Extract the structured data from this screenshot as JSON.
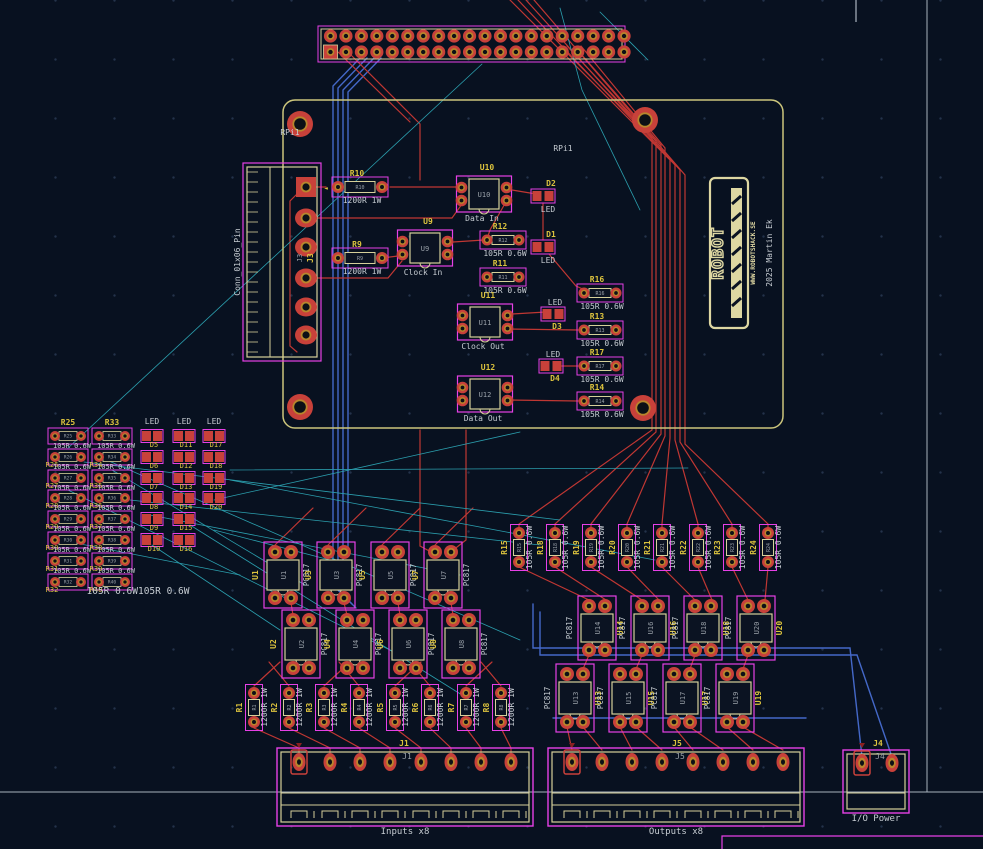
{
  "app": {
    "view_name": "pcb-layout-editor-canvas"
  },
  "colors": {
    "bg": "#081120",
    "grid_dot": "#24324a",
    "copper_red": "#c03733",
    "pad_red": "#c8413a",
    "gold": "#b8862c",
    "hole": "#0c1016",
    "courtyard_magenta": "#e640e6",
    "silk_cream": "#d6d09a",
    "ref_yellow": "#dcc33e",
    "text_white": "#c6ccd2",
    "copper_blue": "#4468c8",
    "ratsnest_cyan": "#2b9fae",
    "board_edge": "#ccc67c",
    "frame_gray": "#a8b2bd",
    "inner_ref_gray": "#9aa1a9",
    "logo_cream": "#ded7a2",
    "pin1_dark_red": "#8a2020"
  },
  "labels": {
    "rpi_hole": "RPi1",
    "rpi_silk": "RPi1",
    "led": "LED",
    "pc817": "PC817",
    "conn_left": "Conn_01x06_Pin",
    "inputs": "Inputs x8",
    "outputs": "Outputs x8",
    "io_power": "I/O Power"
  },
  "logo": {
    "text": "ROBOT",
    "url": "WWW.ROBOTSHACK.SE",
    "credit": "2025 Martin Ek"
  },
  "header40": {
    "x": 318,
    "y": 26,
    "w": 307,
    "h": 36,
    "rows_y": [
      36,
      52
    ],
    "x0": 330.5,
    "pitch": 15.45,
    "cols": 20
  },
  "j3": {
    "ref": "J3",
    "name": "Conn_01x06_Pin",
    "box": [
      243,
      163,
      78,
      198
    ],
    "pads_x": 306,
    "pads_y": [
      187,
      218,
      247,
      278,
      307,
      335
    ]
  },
  "hat": {
    "edge": [
      283,
      100,
      500,
      328
    ],
    "holes": [
      [
        300,
        124
      ],
      [
        645,
        120
      ],
      [
        300,
        407
      ],
      [
        643,
        408
      ]
    ]
  },
  "hat_resistors": [
    {
      "ref": "R10",
      "value": "1200R 1W",
      "cx": 360,
      "cy": 187,
      "size": "big"
    },
    {
      "ref": "R9",
      "value": "1200R 1W",
      "cx": 360,
      "cy": 258,
      "size": "big"
    },
    {
      "ref": "R12",
      "value": "105R 0.6W",
      "cx": 503,
      "cy": 240,
      "size": "small"
    },
    {
      "ref": "R11",
      "value": "105R 0.6W",
      "cx": 503,
      "cy": 277,
      "size": "small"
    },
    {
      "ref": "R16",
      "value": "105R 0.6W",
      "cx": 600,
      "cy": 293,
      "size": "small"
    },
    {
      "ref": "R13",
      "value": "105R 0.6W",
      "cx": 600,
      "cy": 330,
      "size": "small"
    },
    {
      "ref": "R17",
      "value": "105R 0.6W",
      "cx": 600,
      "cy": 366,
      "size": "small"
    },
    {
      "ref": "R14",
      "value": "105R 0.6W",
      "cx": 600,
      "cy": 401,
      "size": "small"
    }
  ],
  "hat_optos": [
    {
      "ref": "U10",
      "label": "Data In",
      "cx": 484,
      "cy": 194
    },
    {
      "ref": "U9",
      "label": "Clock In",
      "cx": 425,
      "cy": 248
    },
    {
      "ref": "U11",
      "label": "Clock Out",
      "cx": 485,
      "cy": 322
    },
    {
      "ref": "U12",
      "label": "Data Out",
      "cx": 485,
      "cy": 394
    }
  ],
  "hat_leds": [
    {
      "ref": "D2",
      "cx": 543,
      "cy": 196,
      "ref_pos": "above"
    },
    {
      "ref": "D1",
      "cx": 543,
      "cy": 247,
      "ref_pos": "above"
    },
    {
      "ref": "D3",
      "cx": 553,
      "cy": 314,
      "ref_pos": "below"
    },
    {
      "ref": "D4",
      "cx": 551,
      "cy": 366,
      "ref_pos": "below"
    }
  ],
  "left_array": {
    "value": "105R 0.6W",
    "bottom_value": "105R 0.6W105R 0.6W",
    "res_rows_y": [
      436,
      457,
      478,
      498,
      519,
      540,
      561,
      582
    ],
    "res_cols": [
      {
        "x": 68,
        "refs": [
          "R25",
          "R26",
          "R27",
          "R28",
          "R29",
          "R30",
          "R31",
          "R32"
        ]
      },
      {
        "x": 112,
        "refs": [
          "R33",
          "R34",
          "R35",
          "R36",
          "R37",
          "R38",
          "R39",
          "R40"
        ]
      }
    ],
    "led_rows_y": [
      436,
      457,
      478,
      498,
      519,
      540
    ],
    "led_cols": [
      {
        "x": 152,
        "refs": [
          "D5",
          "D6",
          "D7",
          "D8",
          "D9",
          "D10"
        ]
      },
      {
        "x": 184,
        "refs": [
          "D11",
          "D12",
          "D13",
          "D14",
          "D15",
          "D16"
        ]
      },
      {
        "x": 214,
        "refs": [
          "D17",
          "D18",
          "D19",
          "D20"
        ]
      }
    ]
  },
  "input_section": {
    "opto_value": "PC817",
    "opto_top": {
      "refs": [
        "U1",
        "U3",
        "U5",
        "U7"
      ],
      "cx": [
        283,
        336,
        390,
        443
      ],
      "pads_y": [
        552,
        598
      ]
    },
    "opto_bottom": {
      "refs": [
        "U2",
        "U4",
        "U6",
        "U8"
      ],
      "cx": [
        301,
        355,
        408,
        461
      ],
      "pads_y": [
        620,
        668
      ]
    },
    "res_refs": [
      "R1",
      "R2",
      "R3",
      "R4",
      "R5",
      "R6",
      "R7",
      "R8"
    ],
    "res_value": "1200R 1W",
    "res_x": [
      254,
      289,
      324,
      359,
      395,
      430,
      466,
      501
    ],
    "res_pads_y": [
      693,
      722
    ]
  },
  "output_section": {
    "opto_value": "PC817",
    "opto_top": {
      "refs": [
        "U14",
        "U16",
        "U18",
        "U20"
      ],
      "cx": [
        597,
        650,
        703,
        756
      ],
      "pads_y": [
        606,
        650
      ]
    },
    "opto_bottom": {
      "refs": [
        "U13",
        "U15",
        "U17",
        "U19"
      ],
      "cx": [
        575,
        628,
        682,
        735
      ],
      "pads_y": [
        674,
        722
      ]
    },
    "res_refs": [
      "R15",
      "R18",
      "R19",
      "R20",
      "R21",
      "R22",
      "R23",
      "R24"
    ],
    "res_value": "105R 0.6W",
    "res_x": [
      519,
      555,
      591,
      627,
      662,
      698,
      732,
      768
    ],
    "res_pads_y": [
      533,
      562
    ]
  },
  "connectors": {
    "j1": {
      "ref": "J1",
      "label": "Inputs x8",
      "box": [
        277,
        748,
        256,
        78
      ],
      "pads_x": [
        299,
        330,
        360,
        390,
        421,
        451,
        481,
        511
      ],
      "pads_y": 762
    },
    "j5": {
      "ref": "J5",
      "label": "Outputs x8",
      "box": [
        548,
        748,
        256,
        78
      ],
      "pads_x": [
        572,
        602,
        632,
        662,
        693,
        723,
        753,
        783
      ],
      "pads_y": 762
    },
    "j4": {
      "ref": "J4",
      "label": "I/O Power",
      "box": [
        843,
        750,
        66,
        63
      ],
      "pads_x": [
        862,
        892
      ],
      "pads_y": 763
    }
  },
  "traces": {
    "red": [
      [
        [
          560,
          46
        ],
        [
          652,
          138
        ],
        [
          652,
          430
        ],
        [
          519,
          524
        ],
        [
          519,
          531
        ]
      ],
      [
        [
          567,
          46
        ],
        [
          656,
          141
        ],
        [
          656,
          432
        ],
        [
          555,
          524
        ],
        [
          555,
          531
        ]
      ],
      [
        [
          574,
          46
        ],
        [
          661,
          145
        ],
        [
          661,
          434
        ],
        [
          591,
          524
        ],
        [
          591,
          531
        ]
      ],
      [
        [
          581,
          46
        ],
        [
          665,
          148
        ],
        [
          665,
          436
        ],
        [
          627,
          524
        ],
        [
          627,
          531
        ]
      ],
      [
        [
          510,
          0
        ],
        [
          670,
          160
        ],
        [
          670,
          438
        ],
        [
          662,
          524
        ],
        [
          662,
          531
        ]
      ],
      [
        [
          518,
          0
        ],
        [
          675,
          165
        ],
        [
          675,
          440
        ],
        [
          698,
          524
        ],
        [
          698,
          531
        ]
      ],
      [
        [
          526,
          0
        ],
        [
          680,
          170
        ],
        [
          680,
          442
        ],
        [
          732,
          524
        ],
        [
          732,
          531
        ]
      ],
      [
        [
          534,
          0
        ],
        [
          685,
          175
        ],
        [
          685,
          444
        ],
        [
          768,
          524
        ],
        [
          768,
          531
        ]
      ],
      [
        [
          390,
          187
        ],
        [
          457,
          187
        ]
      ],
      [
        [
          315,
          218
        ],
        [
          452,
          218
        ],
        [
          462,
          204
        ]
      ],
      [
        [
          453,
          242
        ],
        [
          484,
          240
        ]
      ],
      [
        [
          382,
          258
        ],
        [
          398,
          256
        ]
      ],
      [
        [
          512,
          190
        ],
        [
          536,
          194
        ]
      ],
      [
        [
          543,
          203
        ],
        [
          543,
          240
        ]
      ],
      [
        [
          549,
          254
        ],
        [
          576,
          286
        ],
        [
          585,
          290
        ]
      ],
      [
        [
          507,
          200
        ],
        [
          490,
          230
        ],
        [
          488,
          236
        ]
      ],
      [
        [
          506,
          329
        ],
        [
          578,
          330
        ]
      ],
      [
        [
          512,
          314
        ],
        [
          546,
          312
        ]
      ],
      [
        [
          560,
          366
        ],
        [
          578,
          366
        ]
      ],
      [
        [
          506,
          400
        ],
        [
          578,
          401
        ]
      ],
      [
        [
          306,
          278
        ],
        [
          388,
          278
        ],
        [
          402,
          261
        ]
      ],
      [
        [
          306,
          187
        ],
        [
          326,
          187
        ]
      ],
      [
        [
          297,
          194
        ],
        [
          290,
          201
        ],
        [
          290,
          346
        ],
        [
          297,
          352
        ]
      ],
      [
        [
          420,
          430
        ],
        [
          420,
          546
        ],
        [
          433,
          553
        ]
      ],
      [
        [
          466,
          430
        ],
        [
          466,
          540
        ],
        [
          452,
          551
        ]
      ],
      [
        [
          348,
          52
        ],
        [
          420,
          124
        ],
        [
          420,
          180
        ]
      ],
      [
        [
          338,
          52
        ],
        [
          410,
          122
        ]
      ]
    ],
    "blue": [
      [
        [
          360,
          58
        ],
        [
          333,
          86
        ],
        [
          333,
          585
        ],
        [
          352,
          604
        ]
      ],
      [
        [
          367,
          58
        ],
        [
          338,
          88
        ],
        [
          338,
          590
        ],
        [
          356,
          608
        ]
      ],
      [
        [
          374,
          58
        ],
        [
          343,
          90
        ],
        [
          343,
          560
        ]
      ],
      [
        [
          381,
          58
        ],
        [
          348,
          92
        ],
        [
          348,
          555
        ]
      ],
      [
        [
          533,
          604
        ],
        [
          533,
          648
        ],
        [
          850,
          648
        ],
        [
          862,
          757
        ]
      ],
      [
        [
          540,
          612
        ],
        [
          540,
          655
        ],
        [
          857,
          655
        ],
        [
          892,
          757
        ]
      ],
      [
        [
          553,
          718
        ],
        [
          806,
          718
        ]
      ]
    ],
    "cyan": [
      [
        [
          68,
          448
        ],
        [
          482,
          64
        ]
      ],
      [
        [
          95,
          455
        ],
        [
          520,
          640
        ]
      ],
      [
        [
          112,
          470
        ],
        [
          305,
          585
        ]
      ],
      [
        [
          68,
          490
        ],
        [
          410,
          660
        ]
      ],
      [
        [
          130,
          500
        ],
        [
          540,
          545
        ]
      ],
      [
        [
          150,
          515
        ],
        [
          460,
          575
        ]
      ],
      [
        [
          230,
          480
        ],
        [
          655,
          560
        ]
      ],
      [
        [
          214,
          530
        ],
        [
          330,
          560
        ]
      ],
      [
        [
          60,
          540
        ],
        [
          240,
          575
        ]
      ],
      [
        [
          152,
          545
        ],
        [
          280,
          630
        ]
      ],
      [
        [
          214,
          500
        ],
        [
          520,
          432
        ]
      ],
      [
        [
          230,
          470
        ],
        [
          688,
          468
        ]
      ],
      [
        [
          560,
          8
        ],
        [
          582,
          90
        ],
        [
          640,
          210
        ]
      ],
      [
        [
          600,
          12
        ],
        [
          648,
          60
        ]
      ],
      [
        [
          84,
          462
        ],
        [
          560,
          520
        ]
      ],
      [
        [
          190,
          525
        ],
        [
          470,
          700
        ]
      ]
    ]
  }
}
